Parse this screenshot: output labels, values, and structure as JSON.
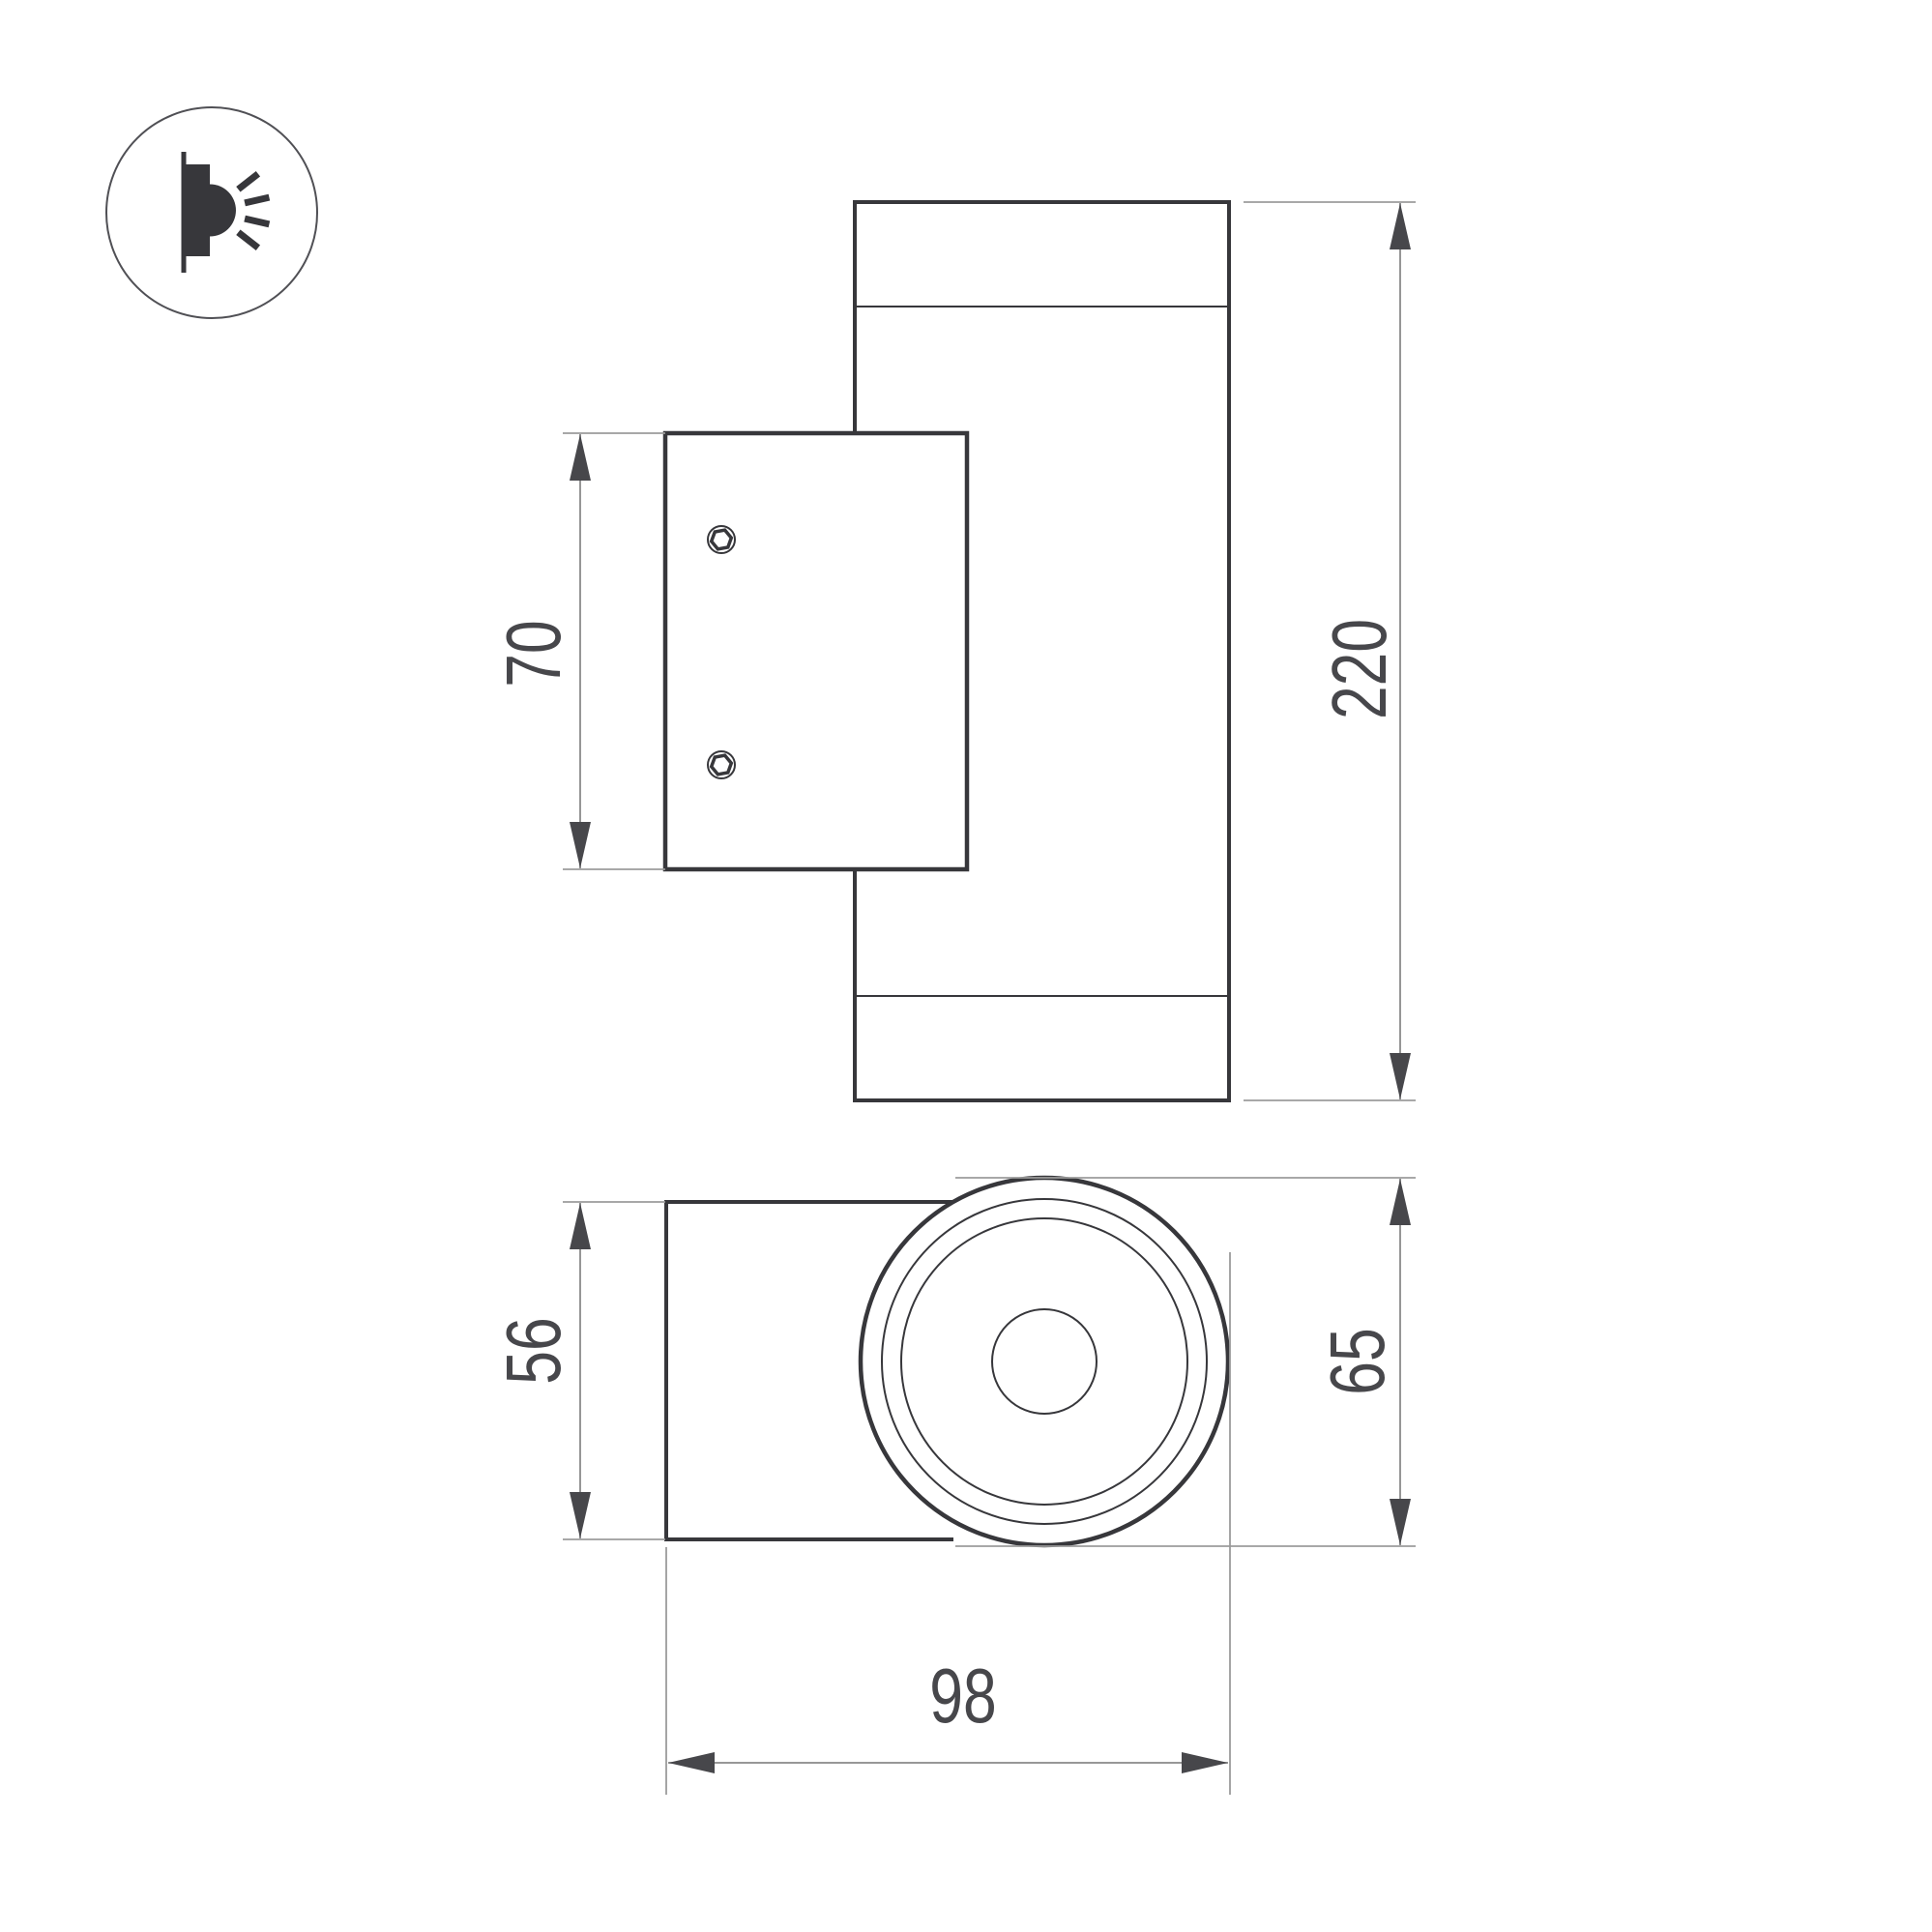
{
  "colors": {
    "background": "#ffffff",
    "object_line": "#37373b",
    "dimension_line": "#8a8a8a",
    "extension_line": "#9b9b9b",
    "arrow": "#47474b",
    "text": "#47474b"
  },
  "icon": {
    "name": "wall-light-icon"
  },
  "dimensions": {
    "plate_height": "70",
    "overall_height": "220",
    "bracket_height": "56",
    "body_diameter": "65",
    "overall_depth": "98"
  }
}
